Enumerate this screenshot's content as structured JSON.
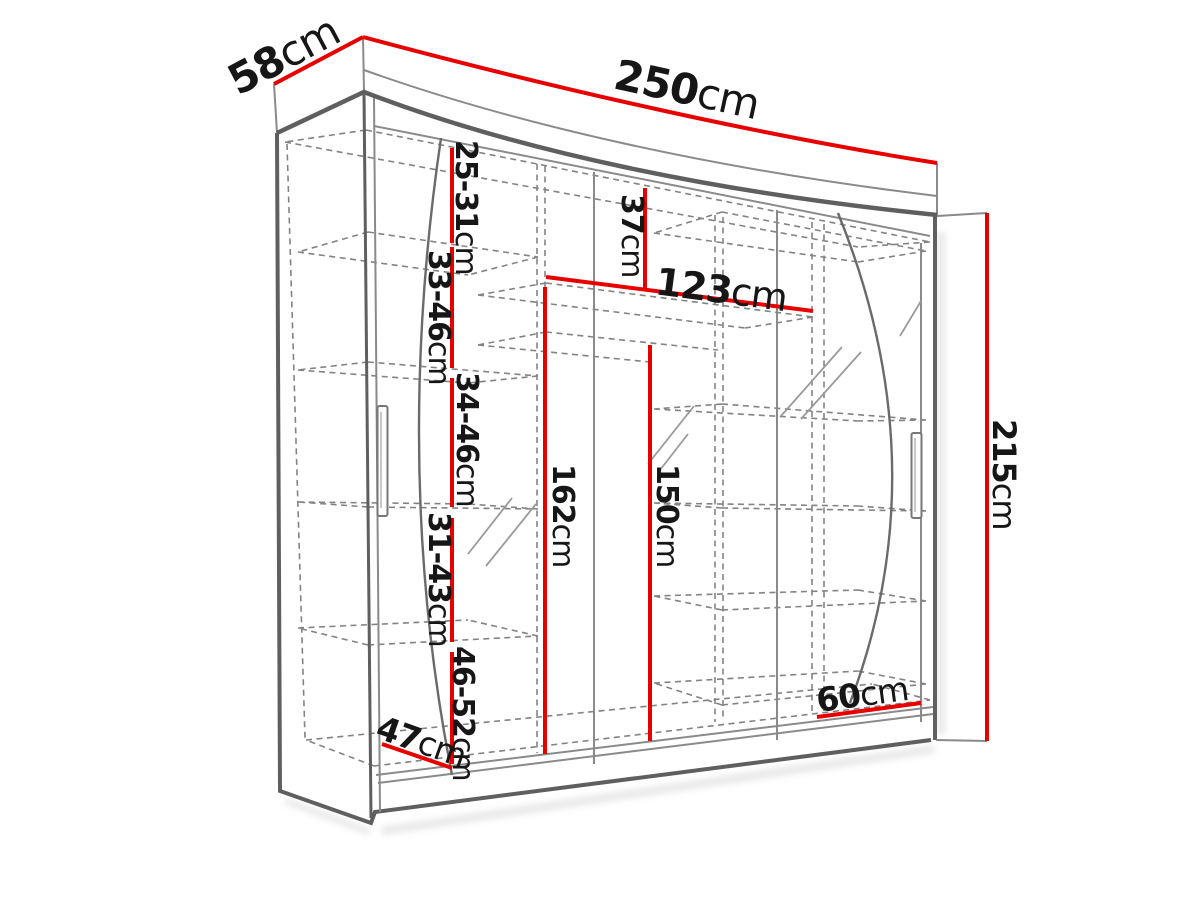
{
  "diagram": {
    "type": "furniture-dimension-drawing",
    "subject": "sliding-door wardrobe with mirrored doors, perspective view with red dimension lines",
    "dimensions": {
      "depth_top": {
        "value": "58",
        "unit": "cm"
      },
      "width_top": {
        "value": "250",
        "unit": "cm"
      },
      "height_right": {
        "value": "215",
        "unit": "cm"
      },
      "shelf_gap_1": {
        "value": "25-31",
        "unit": "cm"
      },
      "shelf_gap_2": {
        "value": "33-46",
        "unit": "cm"
      },
      "shelf_gap_3": {
        "value": "34-46",
        "unit": "cm"
      },
      "shelf_gap_4": {
        "value": "31-43",
        "unit": "cm"
      },
      "shelf_gap_5": {
        "value": "46-52",
        "unit": "cm"
      },
      "top_shelf_height": {
        "value": "37",
        "unit": "cm"
      },
      "hanging_section_width": {
        "value": "123",
        "unit": "cm"
      },
      "interior_height_left": {
        "value": "162",
        "unit": "cm"
      },
      "interior_height_right": {
        "value": "150",
        "unit": "cm"
      },
      "bottom_width_right": {
        "value": "60",
        "unit": "cm"
      },
      "interior_depth_bottom": {
        "value": "47",
        "unit": "cm"
      }
    },
    "colors": {
      "dimension_line": "#e80000",
      "outline": "#5f5f5f",
      "hidden_line": "#838383",
      "label_text": "#161616",
      "background": "#ffffff"
    }
  }
}
